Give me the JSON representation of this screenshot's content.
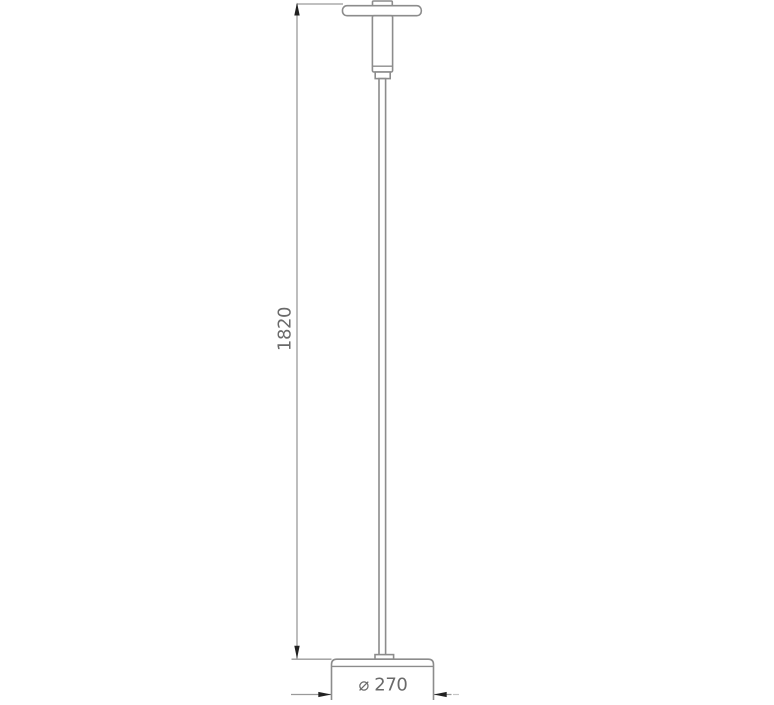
{
  "drawing": {
    "dimensions": {
      "height": {
        "label": "1820"
      },
      "diameter": {
        "label": "⌀ 270"
      }
    },
    "colors": {
      "line": "#8c8c8c",
      "dimension_line": "#9a9a9a",
      "arrow": "#212121",
      "text": "#6a6a6a",
      "background": "#ffffff"
    }
  }
}
